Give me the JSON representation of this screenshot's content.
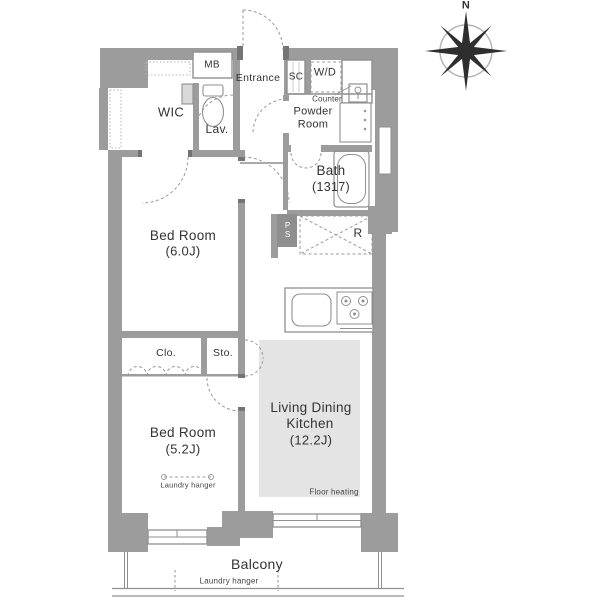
{
  "plan": {
    "compass_north": "N",
    "labels": {
      "mb": "MB",
      "wic": "WIC",
      "lav": "Lav.",
      "entrance": "Entrance",
      "sc": "SC",
      "wd": "W/D",
      "counter": "Counter",
      "powder_room": "Powder Room",
      "bath": "Bath",
      "bath_size": "(1317)",
      "bedroom1": "Bed Room",
      "bedroom1_size": "(6.0J)",
      "refrigerator_space": "R",
      "pipe_space": "PS",
      "closet": "Clo.",
      "storage": "Sto.",
      "bedroom2": "Bed Room",
      "bedroom2_size": "(5.2J)",
      "bedroom2_laundry_hanger": "Laundry hanger",
      "ldk_line1": "Living Dining",
      "ldk_line2": "Kitchen",
      "ldk_size": "(12.2J)",
      "floor_heating": "Floor heating",
      "balcony": "Balcony",
      "balcony_laundry_hanger": "Laundry hanger"
    },
    "colors": {
      "wall": "#9c9c9c",
      "floor_heating_fill": "#e4e4e4",
      "dashed_line": "#9a9a9a",
      "text": "#333333",
      "pipe_space_fill": "#8f8f8f"
    }
  }
}
